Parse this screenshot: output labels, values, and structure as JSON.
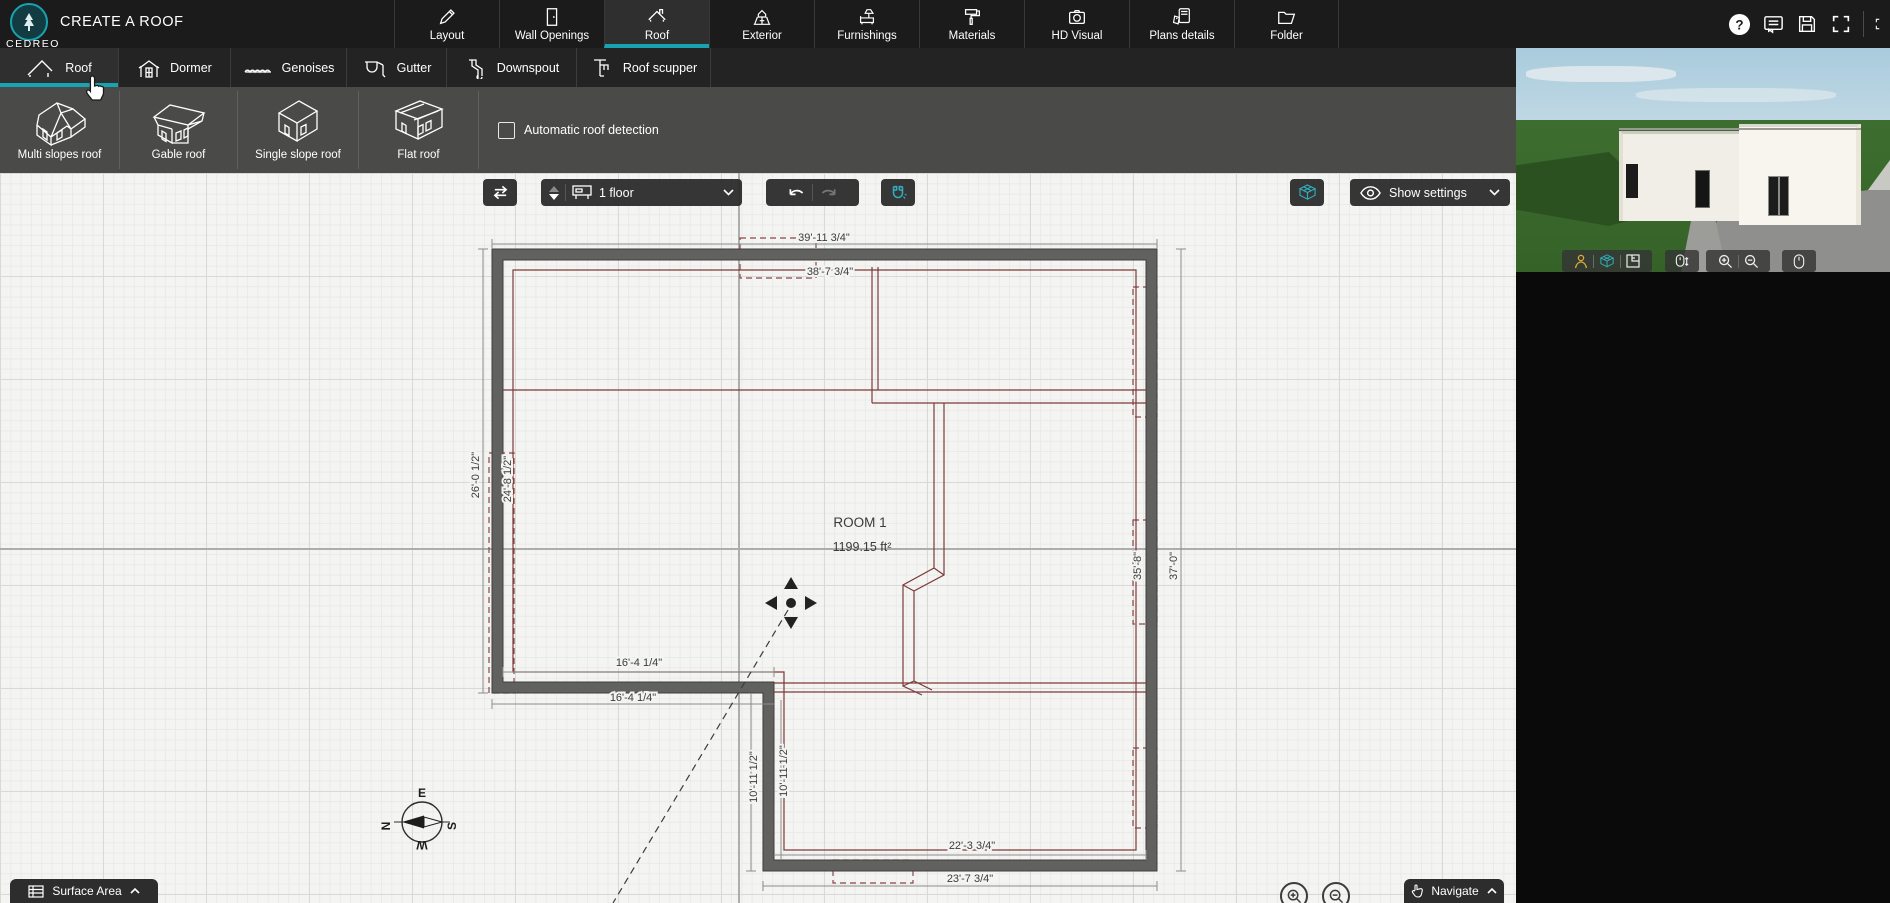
{
  "brand": {
    "logo": "CEDREO",
    "title": "CREATE A ROOF"
  },
  "topbar": {
    "items": [
      {
        "label": "Layout",
        "icon": "pencil-icon"
      },
      {
        "label": "Wall Openings",
        "icon": "door-icon"
      },
      {
        "label": "Roof",
        "icon": "roof-icon",
        "active": true
      },
      {
        "label": "Exterior",
        "icon": "house-yard-icon"
      },
      {
        "label": "Furnishings",
        "icon": "sofa-lamp-icon"
      },
      {
        "label": "Materials",
        "icon": "paint-roller-icon"
      },
      {
        "label": "HD Visual",
        "icon": "camera-icon"
      },
      {
        "label": "Plans details",
        "icon": "plan-tags-icon"
      },
      {
        "label": "Folder",
        "icon": "folder-icon"
      }
    ],
    "right_icons": [
      "help-icon",
      "comments-icon",
      "save-icon",
      "fullscreen-icon",
      "apps-icon"
    ]
  },
  "subtabs": [
    {
      "label": "Roof",
      "active": true
    },
    {
      "label": "Dormer",
      "active": false
    },
    {
      "label": "Genoises",
      "active": false
    },
    {
      "label": "Gutter",
      "active": false
    },
    {
      "label": "Downspout",
      "active": false
    },
    {
      "label": "Roof scupper",
      "active": false
    }
  ],
  "roof_types": {
    "buttons": [
      {
        "label": "Multi slopes roof"
      },
      {
        "label": "Gable roof"
      },
      {
        "label": "Single slope roof"
      },
      {
        "label": "Flat roof"
      }
    ],
    "auto_detect": {
      "label": "Automatic roof detection",
      "checked": false
    }
  },
  "canvas_toolbar": {
    "floor_selector_value": "1 floor",
    "show_settings_label": "Show settings"
  },
  "plan": {
    "room": {
      "name": "ROOM 1",
      "area": "1199.15 ft²"
    },
    "dimensions": {
      "top_outer": "39'-11 3/4\"",
      "top_inner": "38'-7 3/4\"",
      "left_outer": "26'-0 1/2\"",
      "left_inner": "24'-8 1/2\"",
      "bottom_left_upper": "16'-4 1/4\"",
      "bottom_left_lower": "16'-4 1/4\"",
      "ext_vertical_inner": "10'-11 1/2\"",
      "ext_vertical_outer": "10'-11 1/2\"",
      "ext_bottom_inner": "22'-3 3/4\"",
      "ext_bottom_outer": "23'-7 3/4\"",
      "right_inner": "35'-8\"",
      "right_outer": "37'-0\""
    },
    "compass": {
      "north": "N",
      "east": "E",
      "south": "S",
      "west": "W"
    }
  },
  "bottom_bar": {
    "surface_area": "Surface Area",
    "navigate": "Navigate"
  },
  "colors": {
    "accent_teal": "#17a3b1",
    "roof_line": "#7c3a3a",
    "wall_fill": "#61615f",
    "canvas_bg": "#f4f4f2"
  }
}
